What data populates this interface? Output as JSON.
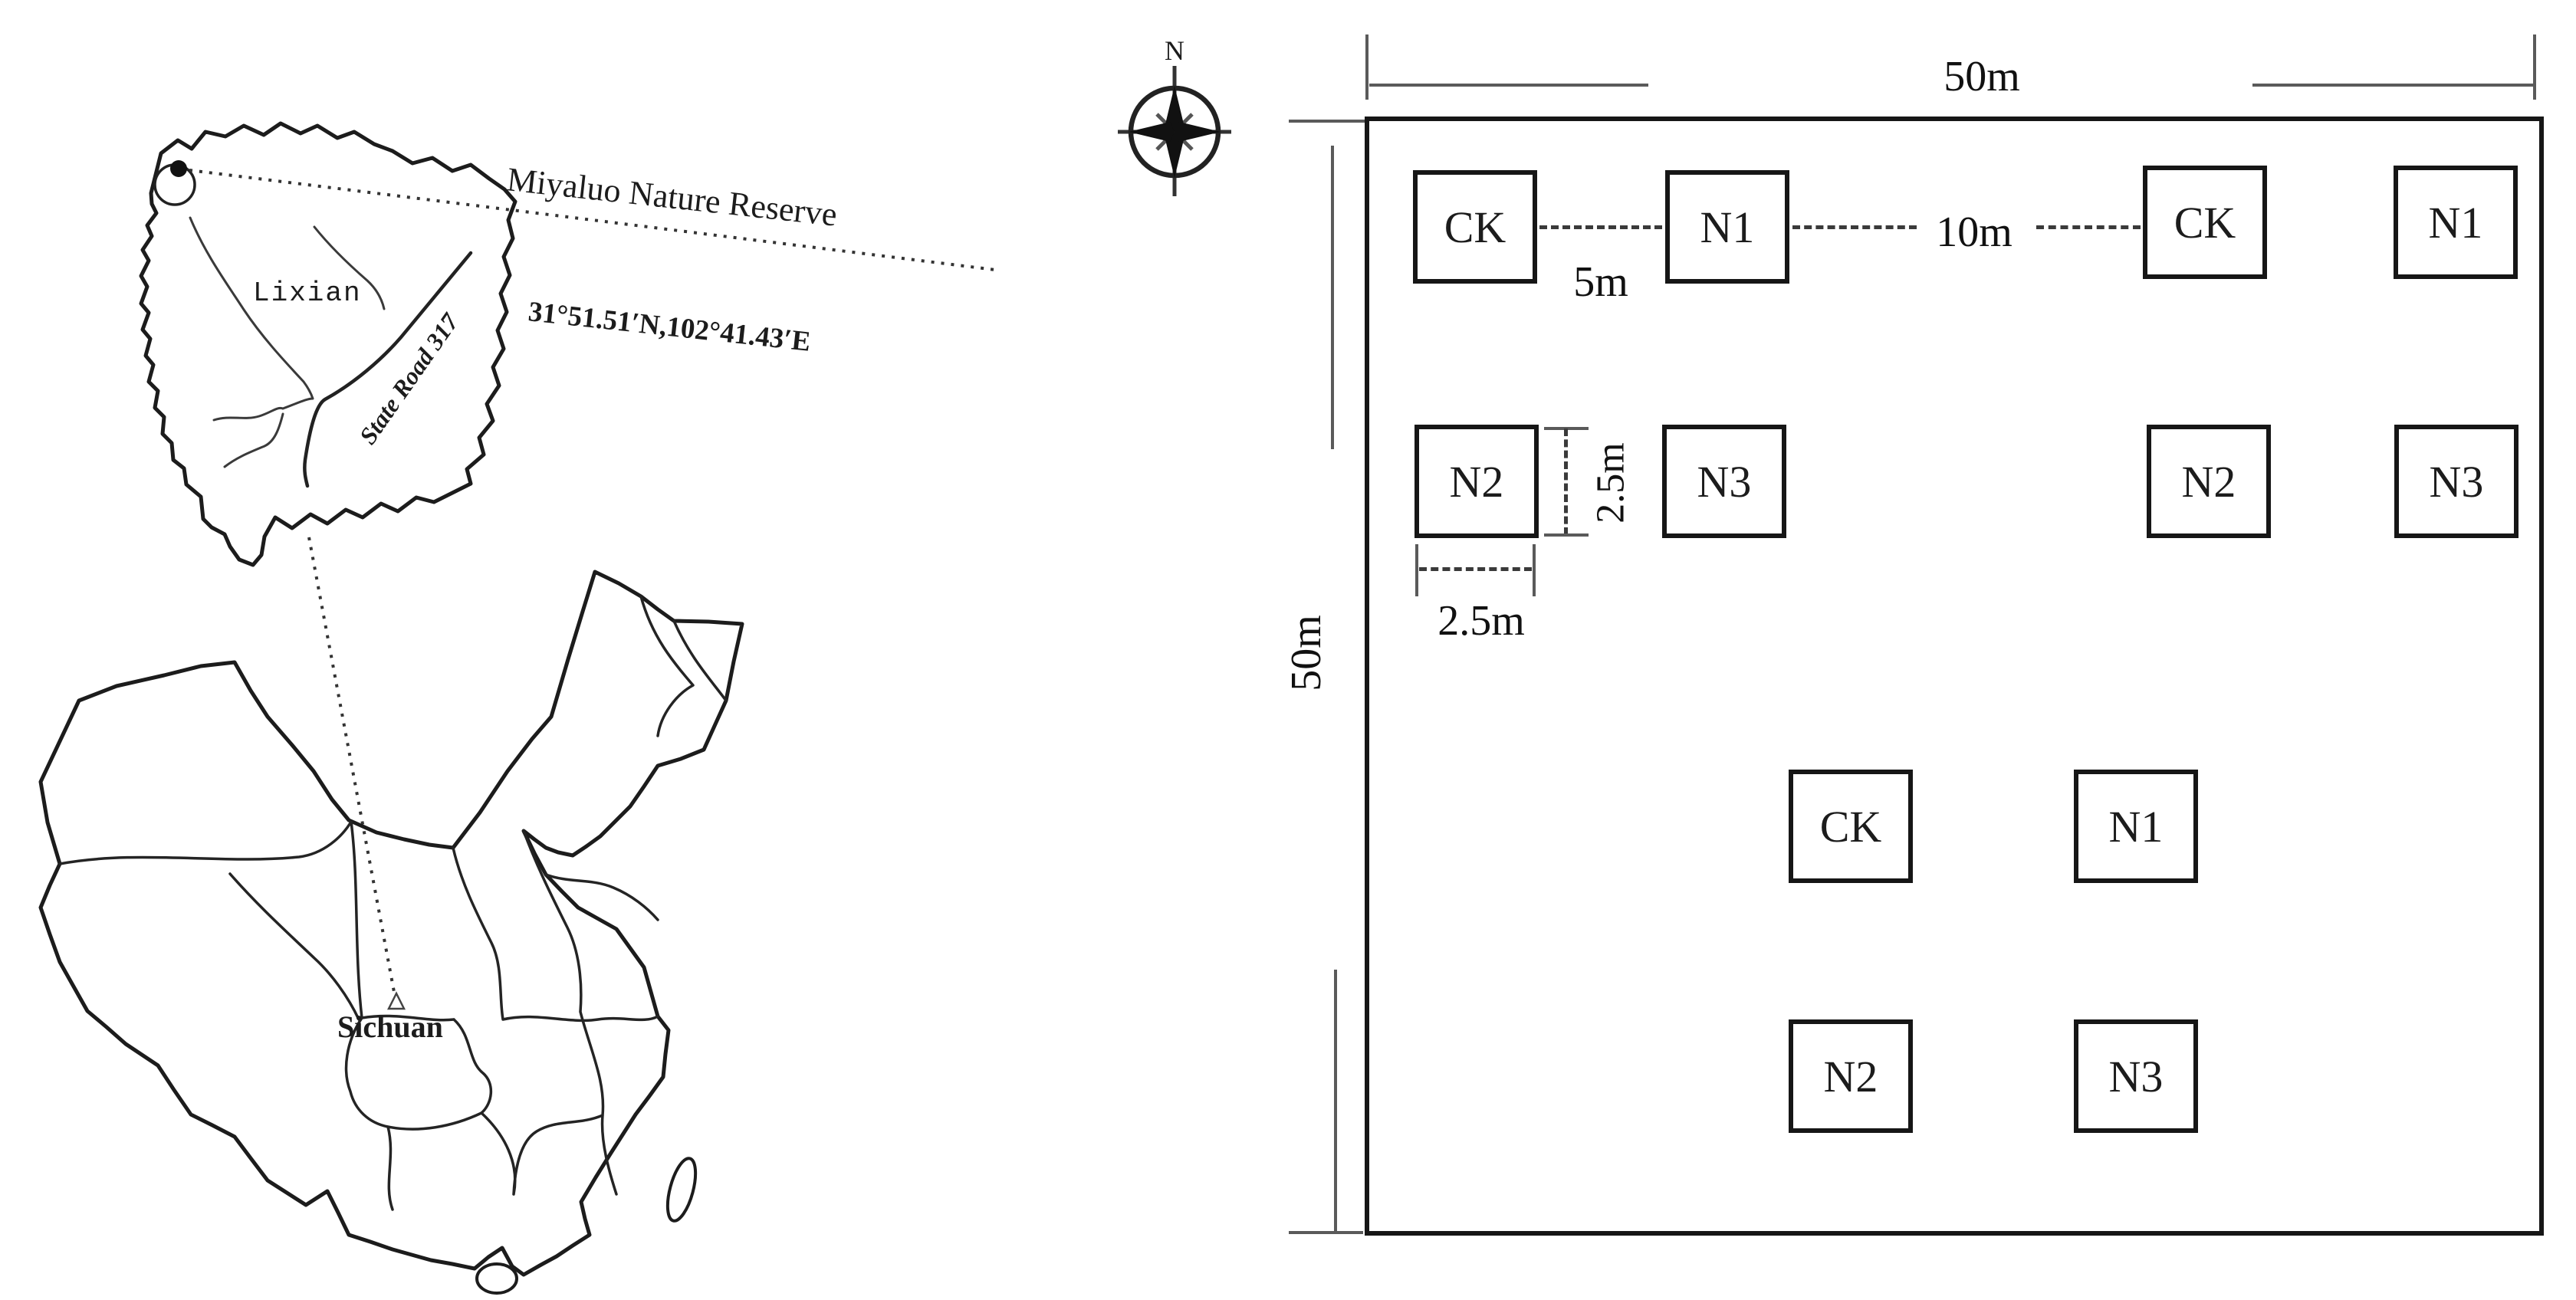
{
  "map_panel": {
    "reserve_name": "Miyaluo  Nature Reserve",
    "reserve_coordinates": "31°51.51′N,102°41.43′E",
    "county_name": "Lixian",
    "road_name": "State Road 317",
    "province_name": "Sichuan",
    "compass_north_label": "N"
  },
  "plot_panel": {
    "field_width_label": "50m",
    "field_height_label": "50m",
    "plot_gap_horizontal_label": "5m",
    "block_gap_label": "10m",
    "plot_height_label": "2.5m",
    "plot_width_label": "2.5m",
    "plots": [
      {
        "label": "CK"
      },
      {
        "label": "N1"
      },
      {
        "label": "CK"
      },
      {
        "label": "N1"
      },
      {
        "label": "N2"
      },
      {
        "label": "N3"
      },
      {
        "label": "N2"
      },
      {
        "label": "N3"
      },
      {
        "label": "CK"
      },
      {
        "label": "N1"
      },
      {
        "label": "N2"
      },
      {
        "label": "N3"
      }
    ]
  },
  "colors": {
    "ink": "#1c1c1c",
    "dimension_line": "#5a5a5a",
    "dashed_line": "#3a3a3a",
    "background": "#ffffff"
  }
}
